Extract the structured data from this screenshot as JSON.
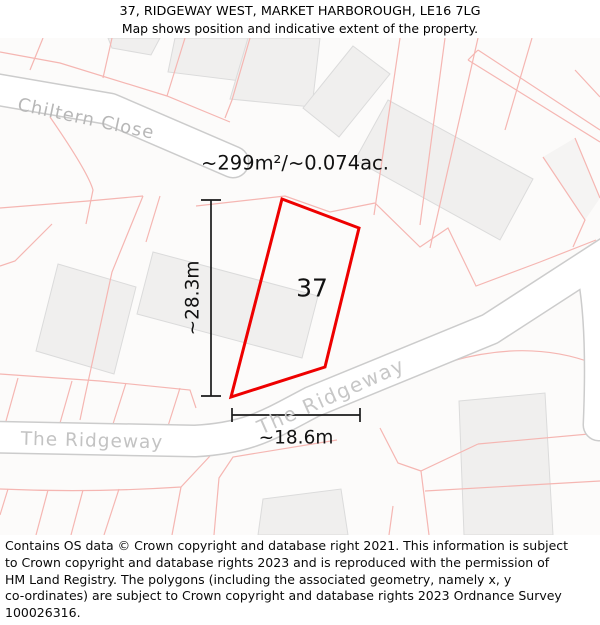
{
  "header": {
    "title": "37, RIDGEWAY WEST, MARKET HARBOROUGH, LE16 7LG",
    "subtitle": "Map shows position and indicative extent of the property."
  },
  "map": {
    "area_label": "~299m²/~0.074ac.",
    "plot_number": "37",
    "dimensions": {
      "vertical": "~28.3m",
      "horizontal": "~18.6m"
    },
    "streets": [
      {
        "name": "Chiltern Close"
      },
      {
        "name": "The Ridgeway"
      },
      {
        "name": "The Ridgeway"
      }
    ],
    "colors": {
      "plot_outline": "#ee0000",
      "parcel_line": "#f5b6b2",
      "building_fill": "#f0efee",
      "building_stroke": "#dbdbdb",
      "road_fill": "#ffffff",
      "road_casing": "#cccccc",
      "dimension_line": "#1a1a1a",
      "street_label": "#bbbbbb",
      "map_background": "#fcfbfa"
    }
  },
  "footer": {
    "lines": [
      "Contains OS data © Crown copyright and database right 2021. This information is subject",
      "to Crown copyright and database rights 2023 and is reproduced with the permission of",
      "HM Land Registry. The polygons (including the associated geometry, namely x, y",
      "co-ordinates) are subject to Crown copyright and database rights 2023 Ordnance Survey",
      "100026316."
    ]
  }
}
